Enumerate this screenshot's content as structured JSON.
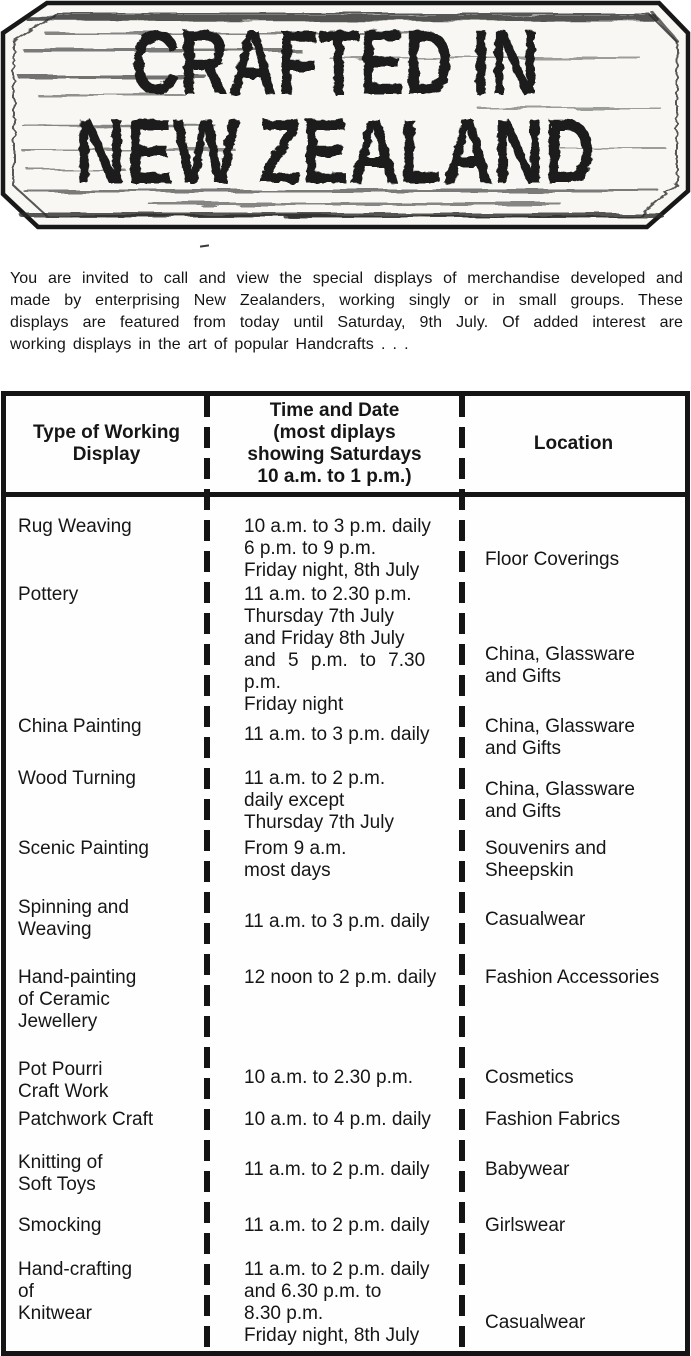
{
  "sign": {
    "line1": "CRAFTED IN",
    "line2": "NEW ZEALAND"
  },
  "intro": {
    "lines": [
      "You are invited to call and view the special displays of merchandise developed and",
      "made by enterprising New Zealanders, working singly or in small groups. These",
      "displays are featured from today until Saturday, 9th July. Of added interest are",
      "working displays in the art of popular Handcrafts . . ."
    ]
  },
  "table": {
    "headers": {
      "type": [
        "Type of Working",
        "Display"
      ],
      "time": [
        "Time and Date",
        "(most diplays",
        "showing Saturdays",
        "10 a.m. to 1 p.m.)"
      ],
      "location": [
        "Location"
      ]
    },
    "rows": [
      {
        "type": [
          "Rug Weaving"
        ],
        "time": [
          "10 a.m. to 3 p.m. daily",
          "6 p.m. to 9 p.m.",
          "Friday night, 8th July"
        ],
        "location": [
          "Floor Coverings"
        ]
      },
      {
        "type": [
          "Pottery"
        ],
        "time": [
          "11 a.m. to 2.30 p.m.",
          "Thursday 7th July",
          "and Friday 8th July",
          "and 5 p.m. to 7.30",
          "p.m.",
          "Friday night"
        ],
        "location": [
          "China, Glassware",
          "and Gifts"
        ]
      },
      {
        "type": [
          "China Painting"
        ],
        "time": [
          "11 a.m. to 3 p.m. daily"
        ],
        "location": [
          "China, Glassware",
          "and Gifts"
        ]
      },
      {
        "type": [
          "Wood Turning"
        ],
        "time": [
          "11 a.m. to 2 p.m.",
          "daily except",
          "Thursday 7th July"
        ],
        "location": [
          "China, Glassware",
          "and Gifts"
        ]
      },
      {
        "type": [
          "Scenic Painting"
        ],
        "time": [
          "From 9 a.m.",
          "most days"
        ],
        "location": [
          "Souvenirs and",
          "Sheepskin"
        ]
      },
      {
        "type": [
          "Spinning and",
          "Weaving"
        ],
        "time": [
          "11 a.m. to 3 p.m. daily"
        ],
        "location": [
          "Casualwear"
        ]
      },
      {
        "type": [
          "Hand-painting",
          "of Ceramic",
          "Jewellery"
        ],
        "time": [
          "12 noon to 2 p.m. daily"
        ],
        "location": [
          "Fashion Accessories"
        ]
      },
      {
        "type": [
          "Pot Pourri",
          "Craft Work"
        ],
        "time": [
          "10 a.m. to 2.30 p.m."
        ],
        "location": [
          "Cosmetics"
        ]
      },
      {
        "type": [
          "Patchwork Craft"
        ],
        "time": [
          "10 a.m. to 4 p.m. daily"
        ],
        "location": [
          "Fashion Fabrics"
        ]
      },
      {
        "type": [
          "Knitting of",
          "Soft Toys"
        ],
        "time": [
          "11 a.m. to 2 p.m. daily"
        ],
        "location": [
          "Babywear"
        ]
      },
      {
        "type": [
          "Smocking"
        ],
        "time": [
          "11 a.m. to 2 p.m. daily"
        ],
        "location": [
          "Girlswear"
        ]
      },
      {
        "type": [
          "Hand-crafting",
          "of",
          "Knitwear"
        ],
        "time": [
          "11 a.m. to 2 p.m. daily",
          "and 6.30 p.m. to",
          "8.30 p.m.",
          "Friday night, 8th July"
        ],
        "location": [
          "Casualwear"
        ]
      }
    ]
  }
}
